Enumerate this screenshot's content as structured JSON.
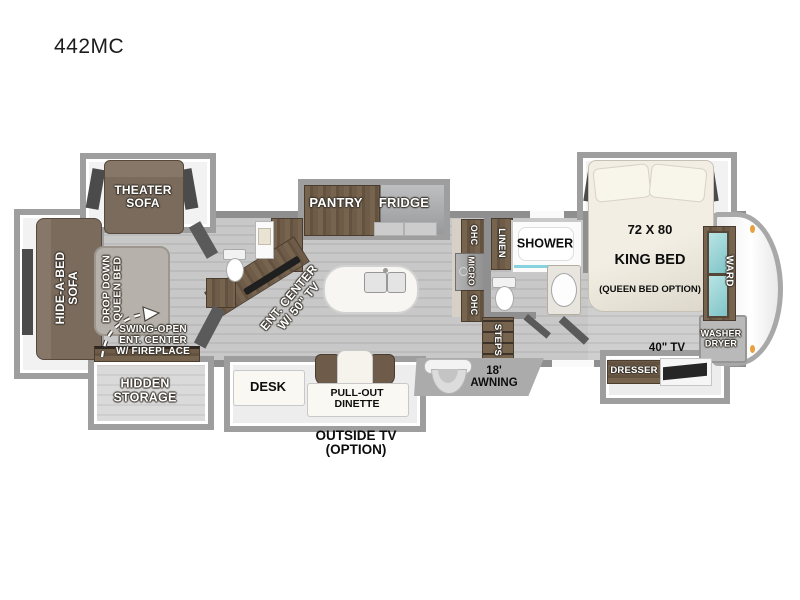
{
  "title": "442MC",
  "colors": {
    "wall": "#8f8f8f",
    "slide_border": "#9e9e9e",
    "floor": "#c6c6c6",
    "wood": "#6a5846",
    "sofa": "#7b6b5d",
    "ward_glass": "#9ed3d4",
    "marker_light": "#e8a13c",
    "tv": "#262626"
  },
  "living": {
    "theater_sofa": "THEATER\nSOFA",
    "hide_a_bed_sofa": "HIDE-A-BED\nSOFA",
    "drop_down_queen_bed": "DROP DOWN\nQUEEN BED",
    "swing_open_note": "SWING-OPEN\nENT. CENTER\nW/ FIREPLACE",
    "hidden_storage": "HIDDEN\nSTORAGE",
    "ent_center": "ENT. CENTER\nW/ 50\" TV",
    "desk": "DESK",
    "pull_out_dinette": "PULL-OUT\nDINETTE",
    "outside_tv_note": "OUTSIDE TV\n(OPTION)"
  },
  "kitchen": {
    "pantry": "PANTRY",
    "fridge": "FRIDGE",
    "ohc_upper": "OHC",
    "micro": "MICRO",
    "ohc_lower": "OHC"
  },
  "bath": {
    "linen": "LINEN",
    "shower": "SHOWER",
    "steps": "STEPS"
  },
  "exterior": {
    "awning": "18'\nAWNING"
  },
  "bedroom": {
    "king_bed_size": "72 X 80",
    "king_bed_type": "KING BED",
    "king_bed_option": "(QUEEN BED OPTION)",
    "ward": "WARD",
    "washer_dryer": "WASHER\nDRYER",
    "tv": "40\" TV",
    "dresser": "DRESSER"
  }
}
